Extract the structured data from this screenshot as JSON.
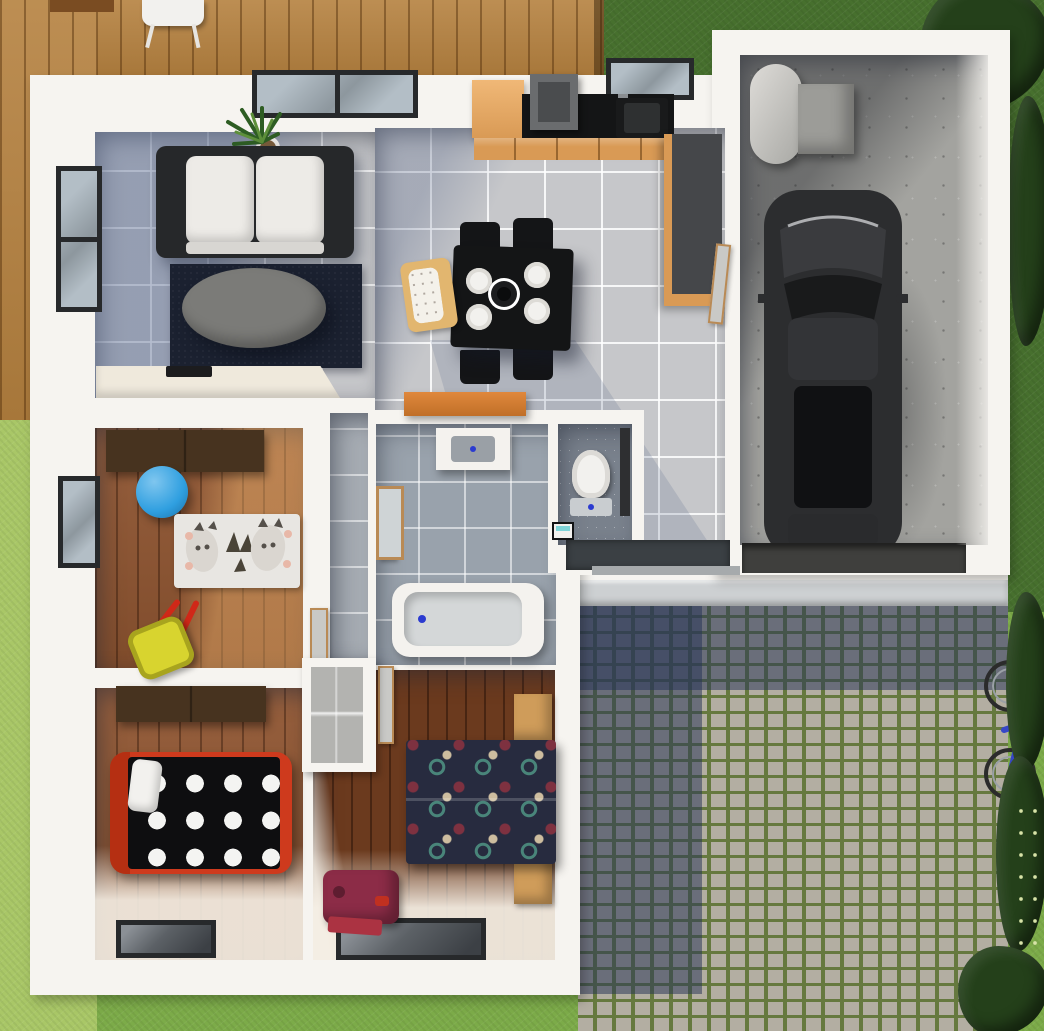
{
  "scene": {
    "title": "3D top-down floor plan rendering of a single-storey house",
    "rooms": [
      {
        "id": "living-room",
        "floor": "blue-grey tile",
        "items": [
          "sofa",
          "navy-rug",
          "oval-coffee-table",
          "potted-plant",
          "tv-sideboard",
          "sliding-window"
        ]
      },
      {
        "id": "kitchen-dining",
        "floor": "light tile",
        "items": [
          "fridge",
          "hob-hood",
          "black-countertop",
          "sink",
          "tall-cabinets",
          "dining-table",
          "four-plates",
          "four-chairs",
          "high-chair"
        ]
      },
      {
        "id": "garage",
        "floor": "concrete",
        "items": [
          "car",
          "water-heater",
          "utility-box",
          "threshold-ramp"
        ]
      },
      {
        "id": "nursery",
        "floor": "wood",
        "items": [
          "wardrobe",
          "blue-ball",
          "animal-rug",
          "toy-wheelbarrow",
          "window"
        ]
      },
      {
        "id": "bathroom",
        "floor": "grey tile",
        "items": [
          "vanity-sink",
          "mirror-panel",
          "bathtub"
        ]
      },
      {
        "id": "wc",
        "floor": "dark tile",
        "items": [
          "toilet",
          "small-washbasin",
          "door"
        ]
      },
      {
        "id": "bedroom-small",
        "floor": "wood",
        "items": [
          "wardrobe",
          "red-frame-bed",
          "polka-dot-duvet",
          "window"
        ]
      },
      {
        "id": "bedroom-master",
        "floor": "dark wood",
        "items": [
          "closet-nook",
          "double-bed-patterned-duvet",
          "nightstands",
          "suitcase",
          "window"
        ]
      },
      {
        "id": "hallway",
        "floor": "grey tile",
        "items": [
          "orange-sideboard",
          "doormat",
          "interior-doors"
        ]
      }
    ],
    "exterior": [
      "wood-deck",
      "deck-chair",
      "lawn",
      "cobblestone-driveway",
      "porch-step",
      "bicycle",
      "hedges"
    ]
  },
  "palette": {
    "wall": "#f6f4f0",
    "tile": "#c6c7ca",
    "bath_tile": "#99a2ac",
    "wc_tile": "#79818c",
    "hall_tile": "#a6acb3",
    "wood_light": "#8f5531",
    "wood_dark": "#6b3a1e",
    "deck": "#b5813f",
    "grass_light": "#a9c767",
    "grass_mid": "#7cab49",
    "grass_dark": "#47702e",
    "bush": "#24401a",
    "concrete": "#a3a39f",
    "cobble": "#b3aea2",
    "cobble_grout": "#66793f",
    "porch": "#cdd0d2",
    "rug_navy": "#1b2130",
    "sofa_black": "#26282a",
    "cushion_white": "#edebe7",
    "coffee_table": "#7b7b78",
    "tv_cabinet": "#efe9dc",
    "counter_wood": "#d99a55",
    "counter_black": "#141516",
    "cabinet_dark": "#45474a",
    "car_body": "#2c2d2f",
    "heater_grey": "#c9c9c5",
    "bed1_frame": "#ce3a1d",
    "duvet1_black": "#0e0e10",
    "duvet2_navy": "#272b3f",
    "nightstand_wood": "#cf9c5a",
    "wardrobe_brown": "#47331f",
    "ball_blue": "#2f9fe0",
    "toy_yellow": "#d8d42f",
    "toy_red": "#d02818",
    "suitcase_maroon": "#8c2c47",
    "sideboard_orange": "#e0883c",
    "window_frame": "#27292b",
    "glass_light": "#b3bec6",
    "glass_dark": "#5c6166",
    "door_leaf": "#c9c9c6",
    "doormat": "#3b4044",
    "bike_blue": "#3646c8",
    "plant_green": "#2e5d23"
  }
}
